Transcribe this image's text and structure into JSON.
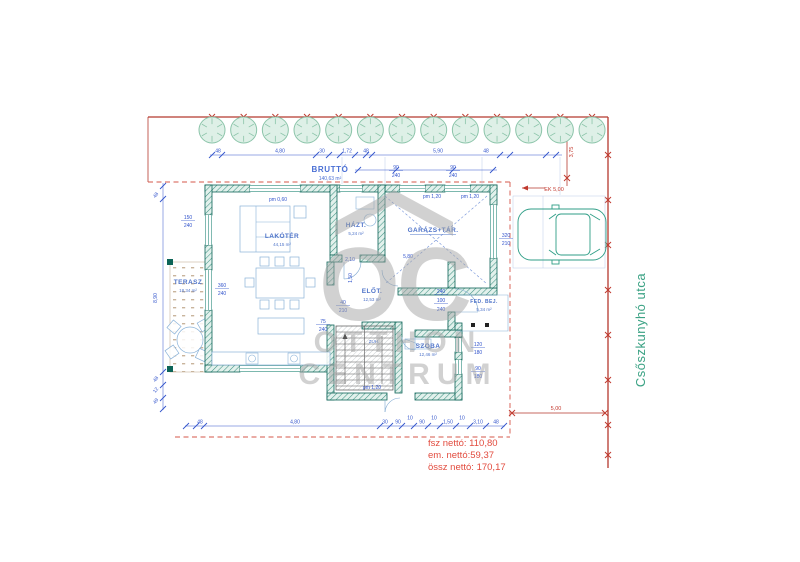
{
  "colors": {
    "wall_teal": "#0d6457",
    "dimension_blue": "#3355cc",
    "boundary_red": "#b5392e",
    "summary_red": "#e24b3e",
    "street_green": "#3ba284",
    "furniture_blue": "#8ab2d8",
    "tree_green": "#8bc4a9",
    "watermark_gray": "#a3a3a3",
    "terrace_tan": "#c9b49c"
  },
  "watermark": {
    "logo_text": "OC",
    "line1": "OTTHON",
    "line2": "CENTRUM"
  },
  "street": {
    "name": "Csőszkunyhó utca"
  },
  "plan": {
    "gross_label": "BRUTTÓ",
    "gross_area": "140,63 m²",
    "rooms": [
      {
        "name": "LAKÓTÉR",
        "area": "44,15 m²"
      },
      {
        "name": "TERASZ",
        "area": "18,34 m²"
      },
      {
        "name": "HÁZT.",
        "area": "5,24 m²"
      },
      {
        "name": "GARÁZS+TÁR.",
        "area": ""
      },
      {
        "name": "ELŐT.",
        "area": "12,53 m²"
      },
      {
        "name": "ZUH.",
        "area": ""
      },
      {
        "name": "SZOBA",
        "area": "12,46 m²"
      },
      {
        "name": "FED. BEJ.",
        "area": "5,34 m²"
      }
    ]
  },
  "summary": {
    "ground_net": "fsz nettó: 110,80",
    "floor_net": "em. nettó:59,37",
    "total_net": "össz nettó: 170,17"
  },
  "dimensions": {
    "top_chain": [
      {
        "t": "48",
        "x": 218
      },
      {
        "t": "4,80",
        "x": 280
      },
      {
        "t": "30",
        "x": 322
      },
      {
        "t": "1,72",
        "x": 347
      },
      {
        "t": "48",
        "x": 366
      },
      {
        "t": "5,90",
        "x": 438
      },
      {
        "t": "48",
        "x": 486
      }
    ],
    "bottom_chain": [
      {
        "t": "48",
        "x": 200
      },
      {
        "t": "4,80",
        "x": 295
      },
      {
        "t": "30",
        "x": 385
      },
      {
        "t": "90",
        "x": 398
      },
      {
        "t": "10",
        "x": 410,
        "dy": -4
      },
      {
        "t": "90",
        "x": 422
      },
      {
        "t": "10",
        "x": 434,
        "dy": -4
      },
      {
        "t": "1,50",
        "x": 448
      },
      {
        "t": "10",
        "x": 462,
        "dy": -4
      },
      {
        "t": "3,10",
        "x": 478
      },
      {
        "t": "48",
        "x": 496
      }
    ],
    "left_chain": [
      {
        "t": "48",
        "y": 196,
        "r": -55
      },
      {
        "t": "8,90",
        "y": 298,
        "r": -90
      },
      {
        "t": "48",
        "y": 380,
        "r": -55
      },
      {
        "t": "12",
        "y": 391,
        "r": -55
      },
      {
        "t": "49",
        "y": 402,
        "r": -55
      }
    ],
    "annotations": [
      {
        "t": "150",
        "x": 188,
        "y": 219,
        "u": 1
      },
      {
        "t": "240",
        "x": 188,
        "y": 227
      },
      {
        "t": "360",
        "x": 222,
        "y": 287,
        "u": 1
      },
      {
        "t": "240",
        "x": 222,
        "y": 295
      },
      {
        "t": "pm 0,60",
        "x": 278,
        "y": 201
      },
      {
        "t": "90",
        "x": 396,
        "y": 169,
        "u": 1
      },
      {
        "t": "240",
        "x": 396,
        "y": 177
      },
      {
        "t": "90",
        "x": 453,
        "y": 169,
        "u": 1
      },
      {
        "t": "240",
        "x": 453,
        "y": 177
      },
      {
        "t": "pm 1,20",
        "x": 432,
        "y": 198
      },
      {
        "t": "pm 1,20",
        "x": 470,
        "y": 198
      },
      {
        "t": "320",
        "x": 506,
        "y": 237,
        "u": 1
      },
      {
        "t": "210",
        "x": 506,
        "y": 245
      },
      {
        "t": "5,80",
        "x": 408,
        "y": 258
      },
      {
        "t": "2,10",
        "x": 350,
        "y": 261
      },
      {
        "t": "40",
        "x": 343,
        "y": 304,
        "u": 1
      },
      {
        "t": "210",
        "x": 343,
        "y": 312
      },
      {
        "t": "75",
        "x": 323,
        "y": 323,
        "u": 1
      },
      {
        "t": "240",
        "x": 323,
        "y": 331
      },
      {
        "t": "240",
        "x": 441,
        "y": 293,
        "u": 1
      },
      {
        "t": "100",
        "x": 441,
        "y": 302,
        "u": 1
      },
      {
        "t": "240",
        "x": 441,
        "y": 311
      },
      {
        "t": "120",
        "x": 478,
        "y": 346,
        "u": 1
      },
      {
        "t": "180",
        "x": 478,
        "y": 354
      },
      {
        "t": "90",
        "x": 478,
        "y": 370,
        "u": 1
      },
      {
        "t": "180",
        "x": 478,
        "y": 378
      },
      {
        "t": "pm 1,20",
        "x": 372,
        "y": 389
      },
      {
        "t": "1,50",
        "x": 352,
        "y": 278,
        "r": -90
      },
      {
        "t": "3,75",
        "x": 573,
        "y": 152,
        "r": -90,
        "red": 1
      },
      {
        "t": "5,00",
        "x": 556,
        "y": 410,
        "red": 1
      },
      {
        "t": "EK 5,00",
        "x": 554,
        "y": 191,
        "red": 1
      }
    ]
  }
}
